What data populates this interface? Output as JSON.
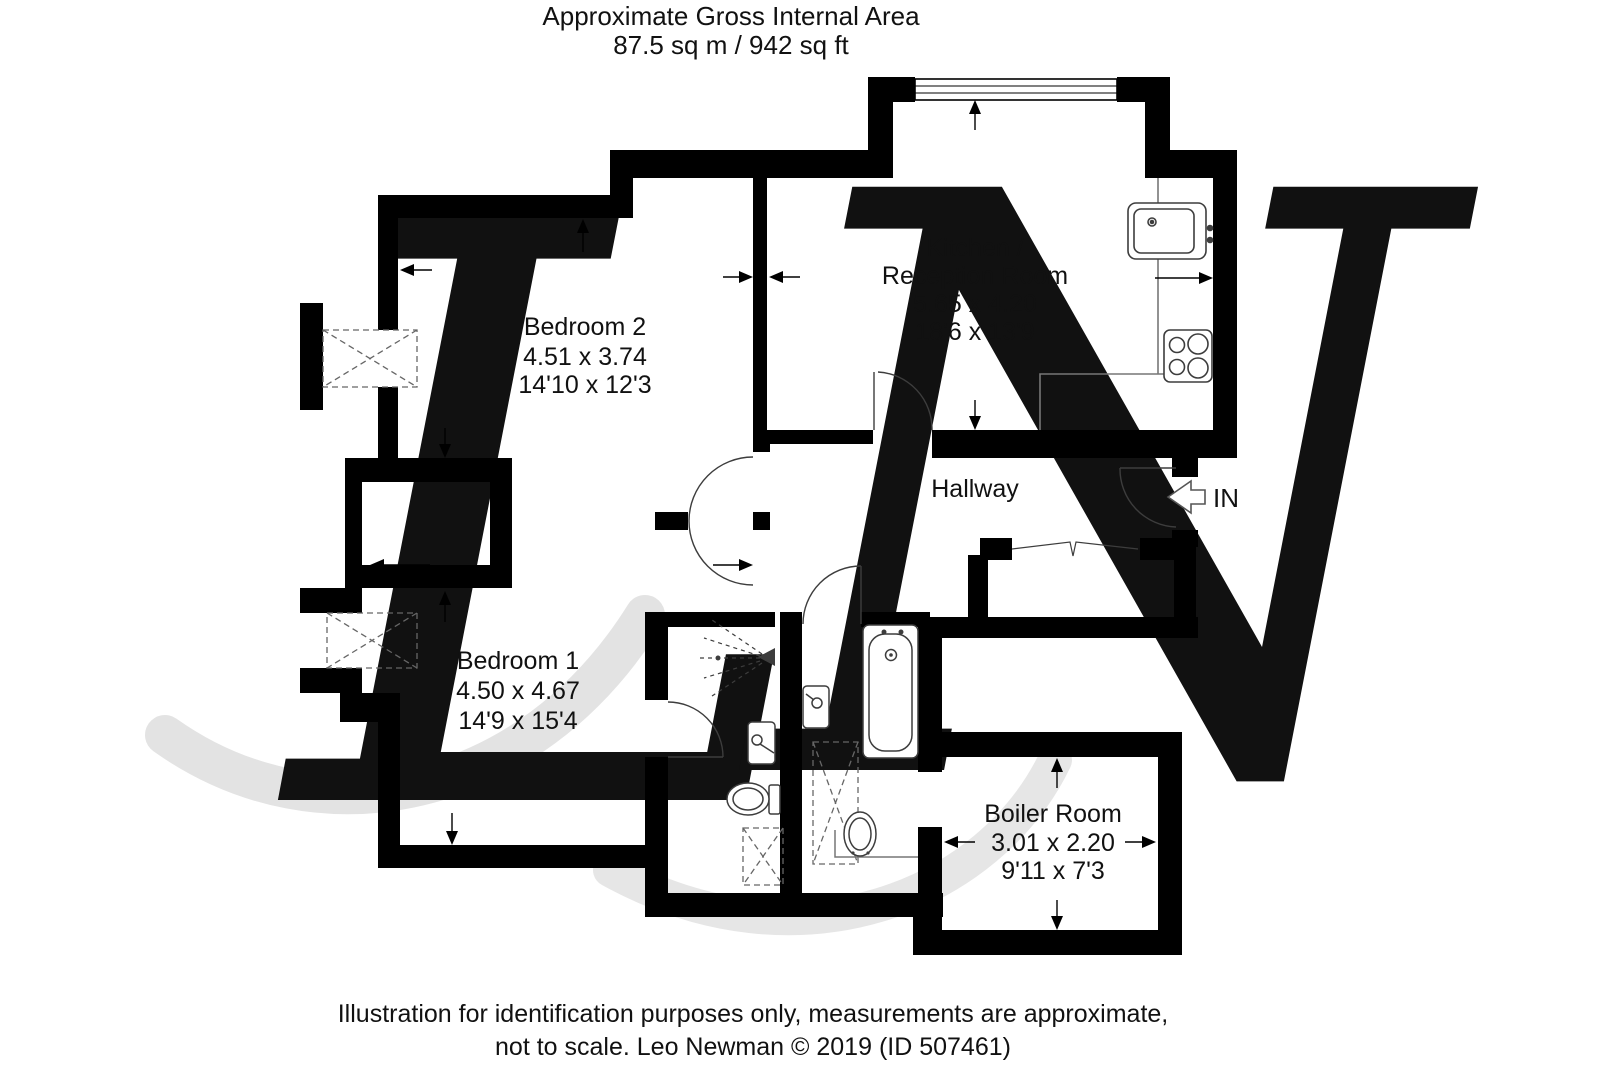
{
  "header": {
    "line1": "Approximate Gross Internal Area",
    "line2": "87.5 sq m / 942 sq ft"
  },
  "rooms": {
    "bedroom2": {
      "name": "Bedroom 2",
      "metric": "4.51 x 3.74",
      "imperial": "14'10 x 12'3"
    },
    "kitchen": {
      "name_line1": "Kitchen /",
      "name_line2": "Reception Room",
      "metric": "5.65 x 4.20",
      "imperial": "18'6 x 13'9"
    },
    "hallway": {
      "name": "Hallway"
    },
    "bedroom1": {
      "name": "Bedroom 1",
      "metric": "4.50 x 4.67",
      "imperial": "14'9 x 15'4"
    },
    "boiler": {
      "name": "Boiler Room",
      "metric": "3.01 x 2.20",
      "imperial": "9'11 x 7'3"
    }
  },
  "entrance": {
    "label": "IN"
  },
  "footer": {
    "line1": "Illustration for identification purposes only, measurements are approximate,",
    "line2": "not to scale. Leo Newman © 2019 (ID 507461)"
  },
  "watermark": {
    "letter1": "L",
    "letter2": "N"
  },
  "colors": {
    "wall": "#000000",
    "fixture": "#3d3d3d",
    "watermark": "#e3e3e3",
    "text": "#111111"
  }
}
